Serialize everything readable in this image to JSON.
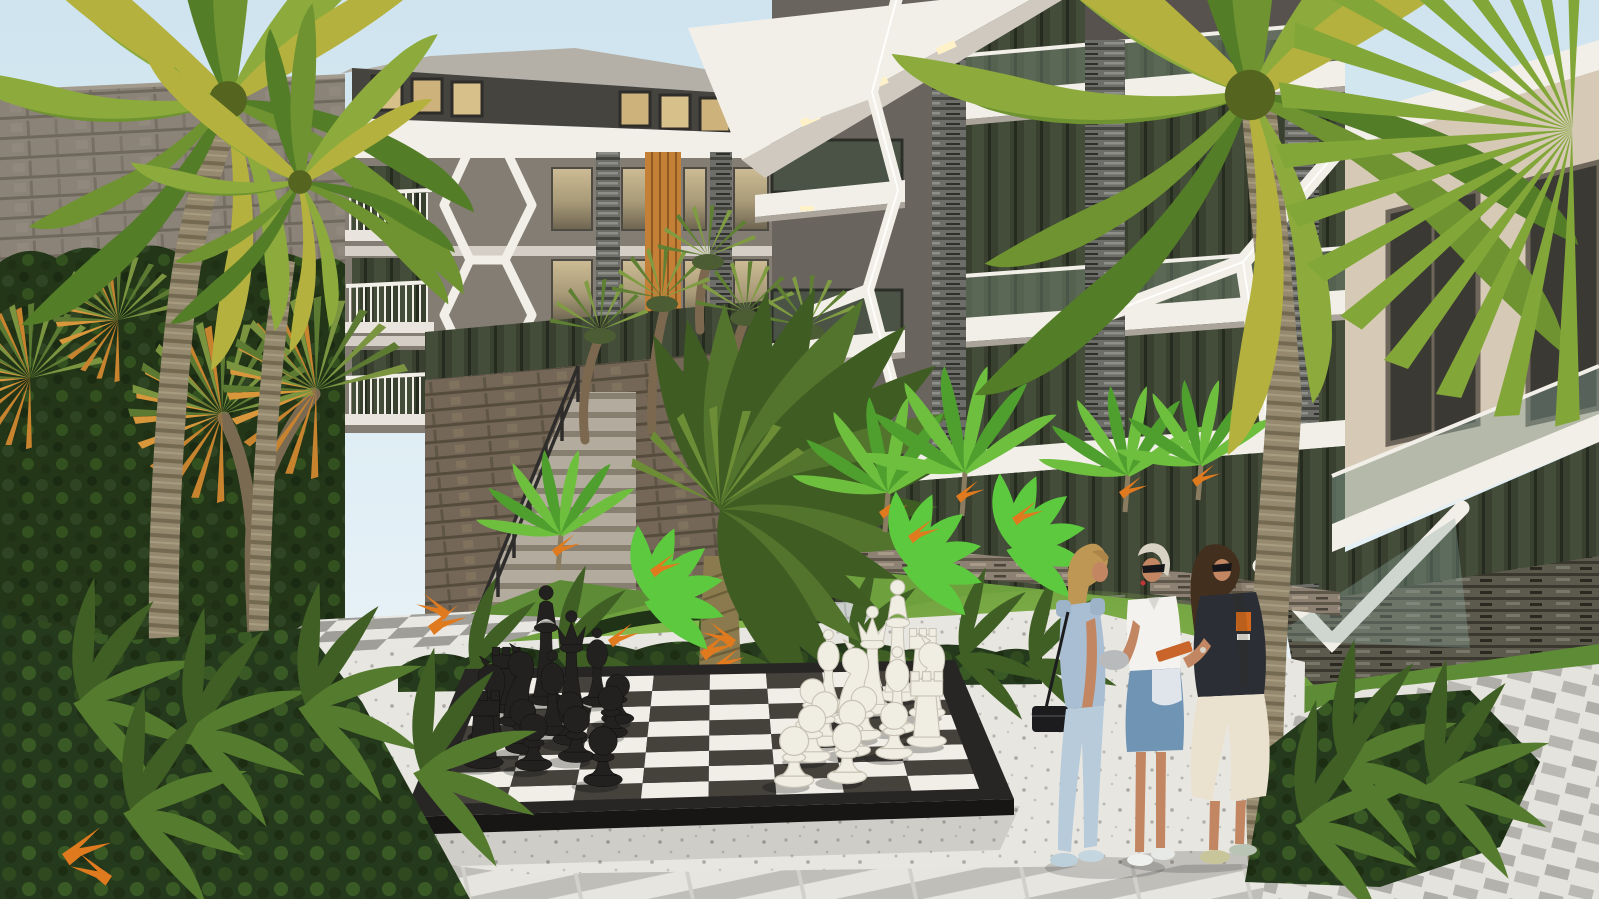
{
  "meta": {
    "kind": "architectural-exterior-render",
    "description": "Daylight 3D rendering of a modern apartment complex courtyard with a giant outdoor chess set, tropical landscaping and three women talking",
    "width_px": 1599,
    "height_px": 899
  },
  "palette": {
    "sky_top": "#cfe4ef",
    "sky_bottom": "#f0f7fa",
    "left_facade": "#847d74",
    "left_roof": "#b4b0a8",
    "attic_dark": "#46443f",
    "attic_window_lit": "#d8c08a",
    "structure_white": "#f2efe8",
    "soffit_shade": "#cfc9bf",
    "center_wall": "#57524d",
    "center_wall_light": "#6a645e",
    "right_facade": "#d6cab7",
    "right_facade_shade": "#c3b7a4",
    "curtain_top": "#cdbc94",
    "curtain_bottom": "#857a5f",
    "glass_dark": "#39402f",
    "glass_green": "#5a6751",
    "balustrade_glass": "rgba(120,140,120,0.45)",
    "orange_slats": "#c58038",
    "pier_stone": "#6d6e6a",
    "warm_stone": "#8c8172",
    "masonry_wall": "#8b8377",
    "retaining_wall": "#746757",
    "hedge_green": "#233618",
    "bed_green": "#253a1c",
    "fern_green": "#557b2e",
    "grass": "#6fa03e",
    "grass_light": "#85b54d",
    "grass_dark": "#5e8c36",
    "palm_green": "#6e9330",
    "palm_light": "#8cab3c",
    "palm_yellow": "#b4b13e",
    "palm_dark": "#547d28",
    "cycad_green": "#3f5c23",
    "cycad_light": "#53742c",
    "yucca_orange": "#c8832f",
    "trunk": "#95896f",
    "trunk_dark": "#746a52",
    "cycad_trunk": "#8a7a4e",
    "terrazzo": "#e8e6e1",
    "paver_gray": "#a09e99",
    "paver_white": "#e9e7e2",
    "board_frame": "#272625",
    "board_side": "#171615",
    "board_dark_sq": "#45423c",
    "board_light_sq": "#f0eee7",
    "piece_black": "#232120",
    "piece_white": "#f0ede3",
    "railing_dark": "#2e2d2b",
    "skin": "#c28762",
    "denim_jumpsuit": "#a9bed2",
    "denim_pants": "#b8cbdb",
    "denim_skirt": "#7094b4",
    "shirt_white": "#f3f2ee",
    "top_black": "#2b2e34",
    "skirt_cream": "#eae1cf",
    "hair_blonde": "#bf9754",
    "hair_platinum": "#d8d2c5",
    "hair_dark": "#432f1e",
    "orange_accent": "#c9642b",
    "silver": "#b8babb",
    "flower_orange": "#e07a1f"
  },
  "scene": {
    "sky": {
      "condition": "clear pale daylight"
    },
    "buildings": [
      {
        "id": "left-block",
        "style": "modern apartment block, grey facade",
        "features": [
          "attic windows with warm light",
          "white fascia",
          "white balcony railings",
          "white hexagonal lattice feature",
          "orange timber slat strip",
          "stacked-stone piers",
          "curtained windows"
        ]
      },
      {
        "id": "center-block",
        "style": "dark grey apartment block",
        "features": [
          "white Y-shaped structural frames with light strips",
          "cantilevered white slabs with recessed lights",
          "glass balustrades",
          "stacked-stone piers",
          "full-height glazing"
        ]
      },
      {
        "id": "right-block",
        "style": "cream apartment block",
        "features": [
          "white roof fascia",
          "large dark windows",
          "glass balcony balustrade",
          "dark stacked-stone base wall",
          "white raking beams"
        ]
      }
    ],
    "hardscape": [
      "stone boundary wall",
      "stone retaining wall with staircase and dark metal railing",
      "checkered grey/white paver path",
      "light paver walkway",
      "white terrazzo chess plaza",
      "striped paver band",
      "basket-weave paving",
      "low stacked-stone garden walls"
    ],
    "vegetation": [
      "tall clipped hedge wall",
      "two large coconut palms",
      "cordyline trees with orange-green heads",
      "joshua-tree style yuccas on slope",
      "large central sago cycad on lawn mound",
      "small palms and banana plants",
      "bird-of-paradise flowers",
      "fern planting beds"
    ],
    "chessboard": {
      "files": 8,
      "ranks": 8,
      "pieces": [
        {
          "type": "rook",
          "color": "black",
          "u": 0.06,
          "v": 0.3
        },
        {
          "type": "knight",
          "color": "black",
          "u": 0.05,
          "v": 0.5
        },
        {
          "type": "pawn",
          "color": "black",
          "u": 0.16,
          "v": 0.27
        },
        {
          "type": "pawn",
          "color": "black",
          "u": 0.24,
          "v": 0.33
        },
        {
          "type": "pawn",
          "color": "black",
          "u": 0.3,
          "v": 0.13
        },
        {
          "type": "pawn",
          "color": "black",
          "u": 0.13,
          "v": 0.41
        },
        {
          "type": "pawn",
          "color": "black",
          "u": 0.22,
          "v": 0.47
        },
        {
          "type": "pawn",
          "color": "black",
          "u": 0.3,
          "v": 0.52
        },
        {
          "type": "bishop",
          "color": "black",
          "u": 0.18,
          "v": 0.55
        },
        {
          "type": "knight",
          "color": "black",
          "u": 0.1,
          "v": 0.63
        },
        {
          "type": "pawn",
          "color": "black",
          "u": 0.31,
          "v": 0.63
        },
        {
          "type": "queen",
          "color": "black",
          "u": 0.21,
          "v": 0.7
        },
        {
          "type": "rook",
          "color": "black",
          "u": 0.07,
          "v": 0.74
        },
        {
          "type": "king",
          "color": "black",
          "u": 0.15,
          "v": 0.8
        },
        {
          "type": "bishop",
          "color": "black",
          "u": 0.26,
          "v": 0.78
        },
        {
          "type": "pawn",
          "color": "white",
          "u": 0.66,
          "v": 0.08
        },
        {
          "type": "pawn",
          "color": "white",
          "u": 0.76,
          "v": 0.1
        },
        {
          "type": "pawn",
          "color": "white",
          "u": 0.7,
          "v": 0.28
        },
        {
          "type": "pawn",
          "color": "white",
          "u": 0.78,
          "v": 0.32
        },
        {
          "type": "pawn",
          "color": "white",
          "u": 0.86,
          "v": 0.29
        },
        {
          "type": "rook",
          "color": "white",
          "u": 0.93,
          "v": 0.38
        },
        {
          "type": "pawn",
          "color": "white",
          "u": 0.73,
          "v": 0.41
        },
        {
          "type": "pawn",
          "color": "white",
          "u": 0.81,
          "v": 0.45
        },
        {
          "type": "bishop",
          "color": "white",
          "u": 0.88,
          "v": 0.5
        },
        {
          "type": "pawn",
          "color": "white",
          "u": 0.71,
          "v": 0.54
        },
        {
          "type": "knight",
          "color": "white",
          "u": 0.79,
          "v": 0.58
        },
        {
          "type": "knight",
          "color": "white",
          "u": 0.95,
          "v": 0.62
        },
        {
          "type": "queen",
          "color": "white",
          "u": 0.84,
          "v": 0.67
        },
        {
          "type": "bishop",
          "color": "white",
          "u": 0.75,
          "v": 0.71
        },
        {
          "type": "king",
          "color": "white",
          "u": 0.9,
          "v": 0.77
        },
        {
          "type": "rook",
          "color": "white",
          "u": 0.96,
          "v": 0.84
        }
      ]
    },
    "people": [
      {
        "id": "woman-blonde",
        "hair": "long blonde",
        "outfit": "light denim sleeveless jumpsuit, black shoulder bag, white clutch, pale blue sneakers"
      },
      {
        "id": "woman-platinum",
        "hair": "short platinum",
        "outfit": "white short-sleeve shirt, denim skirt with white panel, sunglasses, silver clutch, white sneakers"
      },
      {
        "id": "woman-brunette",
        "hair": "long dark brown",
        "outfit": "black oversized top with orange graphic, cream midi skirt, sunglasses, holding orange notebook, metallic sneakers"
      }
    ]
  }
}
